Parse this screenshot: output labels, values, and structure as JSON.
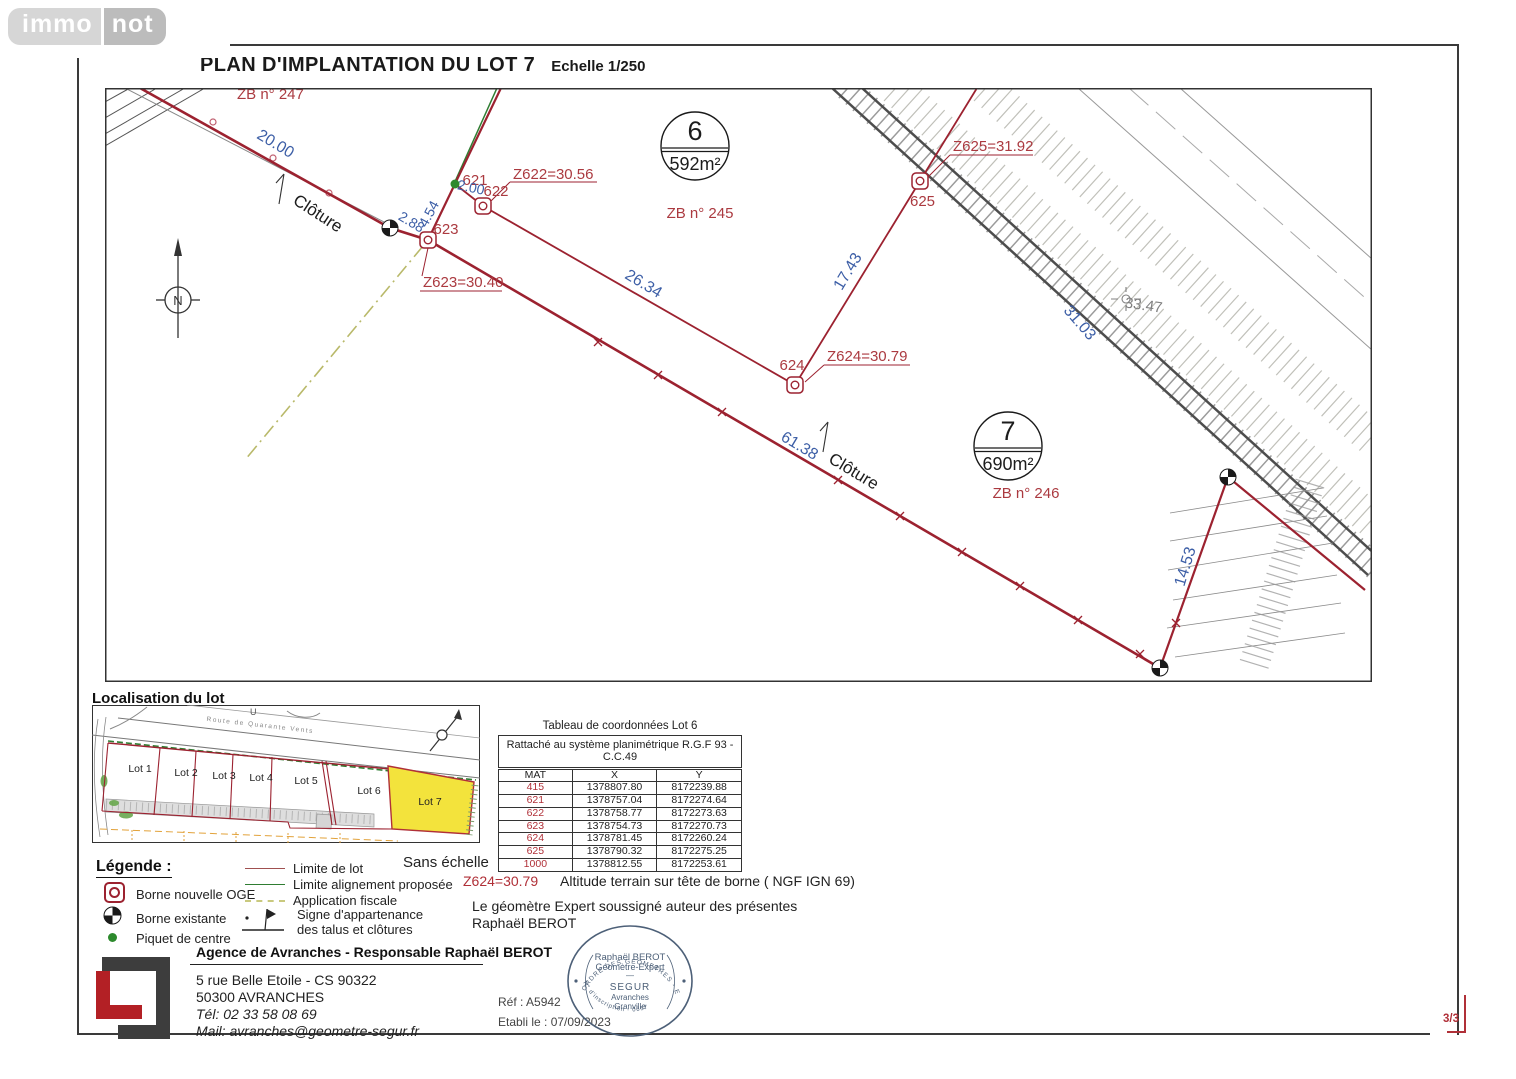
{
  "logo": {
    "immo": "immo",
    "not": "not"
  },
  "title": {
    "main": "PLAN D'IMPLANTATION DU LOT 7",
    "scale": "Echelle 1/250"
  },
  "plan": {
    "zb247": "ZB n° 247",
    "lot6_num": "6",
    "lot6_area": "592m²",
    "lot6_zb": "ZB n° 245",
    "lot7_num": "7",
    "lot7_area": "690m²",
    "lot7_zb": "ZB n° 246",
    "north": "N",
    "cloture": "Clôture",
    "p621": "621",
    "p622": "622",
    "p623": "623",
    "p624": "624",
    "p625": "625",
    "z622": "Z622=30.56",
    "z623": "Z623=30.40",
    "z624": "Z624=30.79",
    "z625": "Z625=31.92",
    "d20": "20.00",
    "d454": "4.54",
    "d288": "2.88",
    "d200": "2.00",
    "d2634": "26.34",
    "d1743": "17.43",
    "d6138": "61.38",
    "d3103": "31.03",
    "d3347": "33.47",
    "d1453": "14.53"
  },
  "inset": {
    "heading": "Localisation du lot",
    "lots": [
      "Lot 1",
      "Lot 2",
      "Lot 3",
      "Lot 4",
      "Lot 5",
      "Lot 6",
      "Lot 7"
    ],
    "road_label": "Route de Quarante Vents",
    "u": "U",
    "no_scale": "Sans échelle"
  },
  "coord_table": {
    "title": "Tableau de coordonnées Lot 6",
    "system": "Rattaché au système planimétrique R.G.F 93 - C.C.49",
    "headers": [
      "MAT",
      "X",
      "Y"
    ],
    "rows": [
      [
        "415",
        "1378807.80",
        "8172239.88"
      ],
      [
        "621",
        "1378757.04",
        "8172274.64"
      ],
      [
        "622",
        "1378758.77",
        "8172273.63"
      ],
      [
        "623",
        "1378754.73",
        "8172270.73"
      ],
      [
        "624",
        "1378781.45",
        "8172260.24"
      ],
      [
        "625",
        "1378790.32",
        "8172275.25"
      ],
      [
        "1000",
        "1378812.55",
        "8172253.61"
      ]
    ]
  },
  "legend": {
    "heading": "Légende :",
    "borne_nouvelle": "Borne nouvelle OGE",
    "borne_existante": "Borne existante",
    "piquet": "Piquet de centre",
    "limite_lot": "Limite de lot",
    "limite_align": "Limite alignement proposée",
    "app_fiscale": "Application fiscale",
    "signe1": "Signe d'appartenance",
    "signe2": "des talus et clôtures"
  },
  "notes": {
    "alt_ref": "Z624=30.79",
    "alt_text": "Altitude terrain sur tête de borne ( NGF IGN 69)",
    "surveyor1": "Le géomètre Expert soussigné auteur des présentes",
    "surveyor2": "Raphaël BEROT"
  },
  "footer": {
    "agency": "Agence de Avranches - Responsable Raphaël BEROT",
    "addr1": "5 rue Belle Etoile - CS 90322",
    "addr2": "50300 AVRANCHES",
    "tel": "Tél: 02 33 58 08 69",
    "mail": "Mail: avranches@geometre-segur.fr",
    "ref": "Réf : A5942",
    "date": "Etabli le : 07/09/2023",
    "page": "3/3"
  },
  "stamp": {
    "arc_top": "ORDRE DES GEOMETRES - EXPERTS",
    "arc_bottom": "N° d'inscription - 0657",
    "l1": "Raphaël BEROT",
    "l2": "Géomètre-Expert",
    "l3": "—",
    "l4": "SEGUR",
    "l5": "Avranches",
    "l6": "Granville"
  },
  "colors": {
    "boundary_red": "#9c2230",
    "label_red": "#ab3a40",
    "dim_blue": "#3c5ea6",
    "piquet_green": "#2d8a2d",
    "align_green": "#2f7d32",
    "fiscale_olive": "#c9c97e",
    "lot7_yellow": "#f3e33c",
    "stamp_blue": "#4d6078",
    "segur_red": "#b32025"
  }
}
